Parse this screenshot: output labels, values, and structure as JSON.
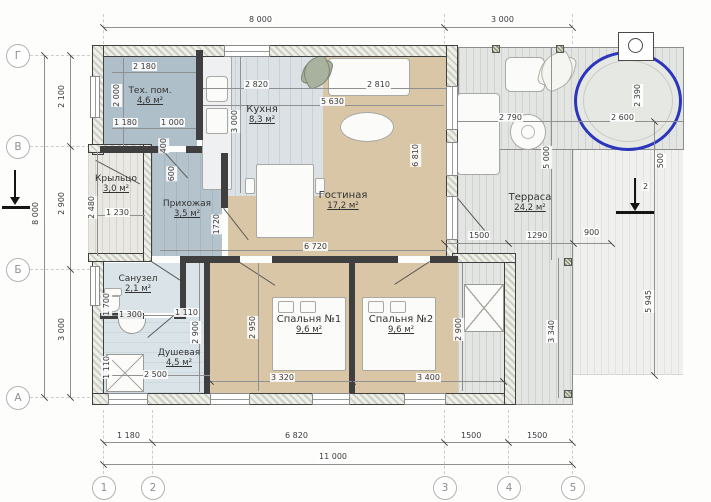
{
  "drawing": {
    "axes": {
      "rows": [
        "Г",
        "В",
        "Б",
        "А"
      ],
      "cols": [
        "1",
        "2",
        "3",
        "4",
        "5"
      ]
    },
    "rooms": {
      "tech": {
        "name": "Тех. пом.",
        "area": "4,6 м²"
      },
      "kitchen": {
        "name": "Кухня",
        "area": "8,3 м²"
      },
      "living": {
        "name": "Гостиная",
        "area": "17,2 м²"
      },
      "porch": {
        "name": "Крыльцо",
        "area": "3,0 м²"
      },
      "hall": {
        "name": "Прихожая",
        "area": "3,5 м²"
      },
      "wc": {
        "name": "Санузел",
        "area": "2,1 м²"
      },
      "shower": {
        "name": "Душевая",
        "area": "4,5 м²"
      },
      "bedroom1": {
        "name": "Спальня №1",
        "area": "9,6 м²"
      },
      "bedroom2": {
        "name": "Спальня №2",
        "area": "9,6 м²"
      },
      "terrace": {
        "name": "Терраса",
        "area": "24,2 м²"
      }
    },
    "dims": {
      "t8000": "8 000",
      "t3000": "3 000",
      "l8000": "8 000",
      "l2100": "2 100",
      "l2900": "2 900",
      "l3000": "3 000",
      "b1180": "1 180",
      "b6820": "6 820",
      "b1500a": "1500",
      "b1500b": "1500",
      "b11000": "11 000",
      "r5945": "5 945",
      "r500": "500",
      "r2": "2",
      "tech2180": "2 180",
      "tech2000": "2 000",
      "tech1180": "1 180",
      "tech1000": "1 000",
      "tech400": "400",
      "tech600": "600",
      "kit2820": "2 820",
      "kit2810": "2 810",
      "kit5630": "5 630",
      "kit3000": "3 000",
      "liv6810": "6 810",
      "liv6720": "6 720",
      "hall2480": "2 480",
      "hall1230": "1 230",
      "hall1720": "1720",
      "wc1700": "1 700",
      "wc1300": "1 300",
      "wc1110": "1 110",
      "sh2900": "2 900",
      "sh1110": "1 110",
      "sh2500": "2 500",
      "bd12950": "2 950",
      "bd13320": "3 320",
      "bd23400": "3 400",
      "bd22900": "2 900",
      "tr2790": "2 790",
      "tr5000": "5 000",
      "tr2390": "2 390",
      "tr2600": "2 600",
      "tr1500": "1500",
      "tr1290": "1290",
      "tr900": "900",
      "tr3340": "3 340"
    },
    "colors": {
      "hot_tub_outline": "#2b36bd",
      "floor_wood": "#d9c6a6",
      "floor_hall": "#b5c3cc",
      "floor_tech": "#aebfca",
      "floor_tile": "#dae4e8",
      "wall": "#3f3f3f"
    }
  }
}
